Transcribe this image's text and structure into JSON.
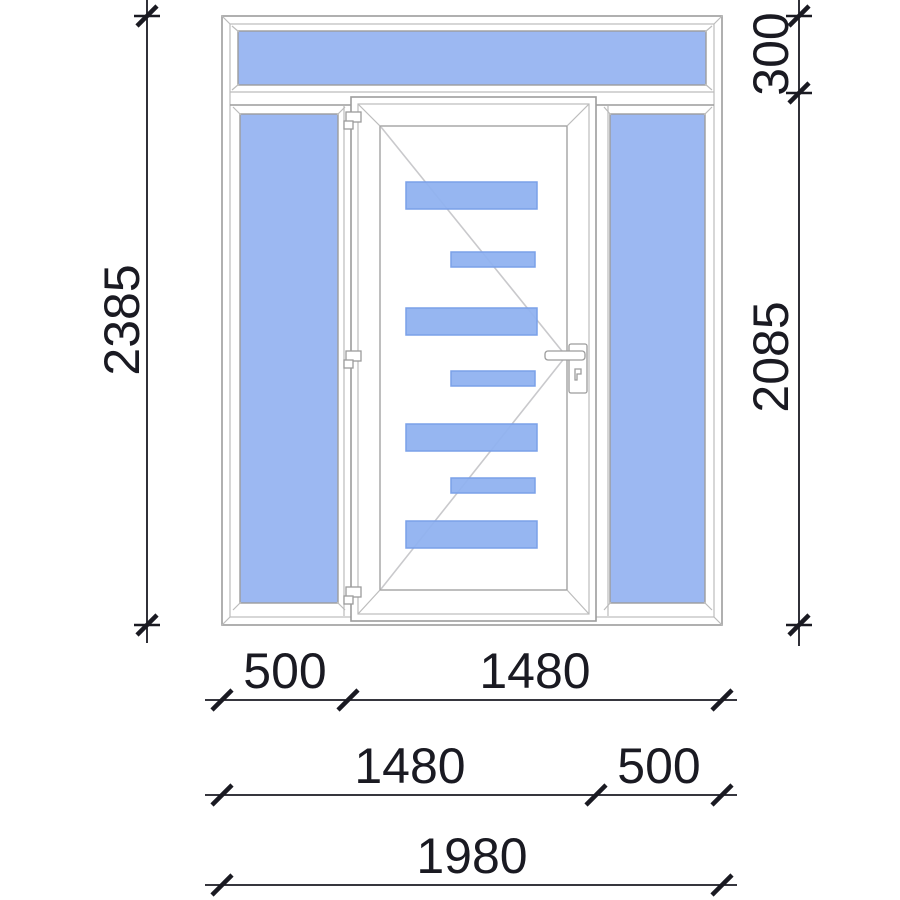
{
  "dimensions": {
    "total_height": "2385",
    "transom_height": "300",
    "main_height": "2085",
    "row1": {
      "left": "500",
      "right": "1480"
    },
    "row2": {
      "left": "1480",
      "right": "500"
    },
    "total_width": "1980"
  },
  "colors": {
    "glass": "#9cb8f2",
    "door_glass_strip": "#8fb1f0",
    "strip_border": "#7aa0e8",
    "outline": "#9c9c9c",
    "outline_light": "#bcbcbc",
    "dimension": "#1a1a22",
    "direction_line": "#c9c9cc"
  }
}
